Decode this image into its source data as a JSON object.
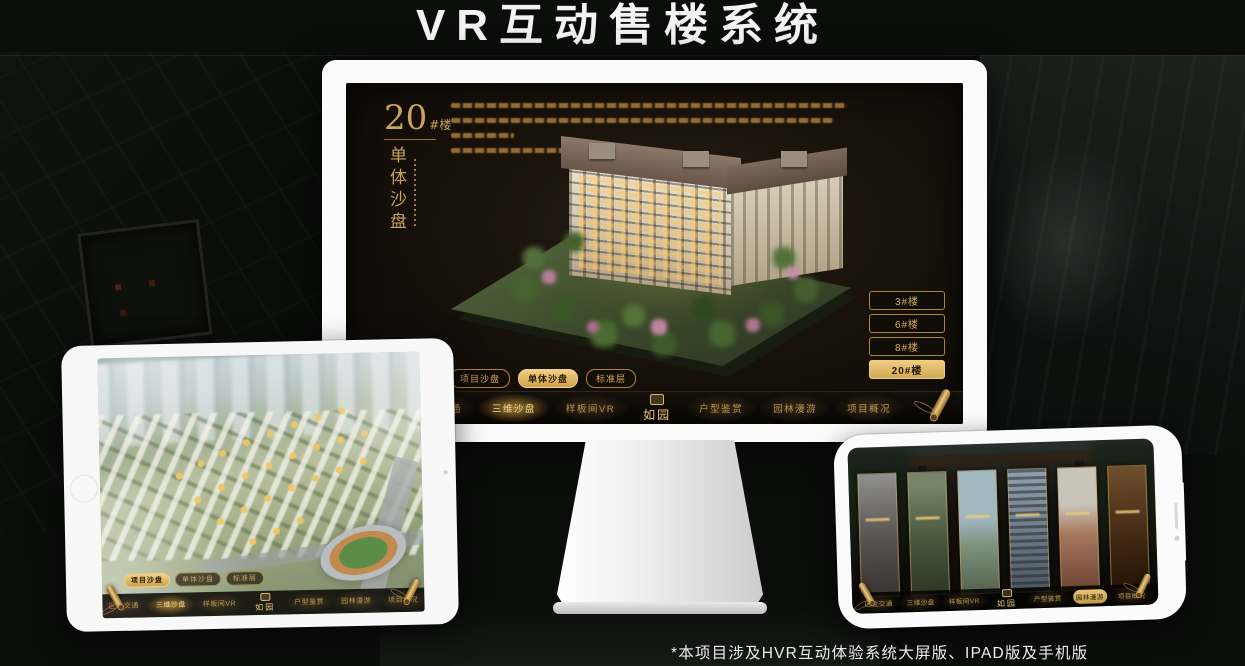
{
  "page": {
    "title": "VR互动售楼系统",
    "footnote": "*本项目涉及HVR互动体验系统大屏版、IPAD版及手机版"
  },
  "colors": {
    "gold": "#c9a45c",
    "gold_bright": "#eecb7c",
    "screen_bg": "#161009",
    "nav_bg": "#0b0805",
    "title_white": "#f3f3f3"
  },
  "sales_app": {
    "logo": "如园",
    "block_label": {
      "number": "20",
      "suffix": "#楼"
    },
    "section_title": "单体沙盘",
    "view_tabs": [
      "项目沙盘",
      "单体沙盘",
      "标准层"
    ],
    "nav_items": [
      "区位交通",
      "三维沙盘",
      "样板间VR",
      "户型鉴赏",
      "园林漫游",
      "项目概况"
    ],
    "building_buttons": [
      "3#楼",
      "6#楼",
      "8#楼",
      "20#楼"
    ],
    "monitor": {
      "active_view_tab": "单体沙盘",
      "active_building": "20#楼",
      "active_nav": "三维沙盘"
    },
    "tablet": {
      "active_view_tab": "项目沙盘",
      "active_nav": "三维沙盘"
    },
    "phone": {
      "active_nav": "园林漫游"
    }
  }
}
